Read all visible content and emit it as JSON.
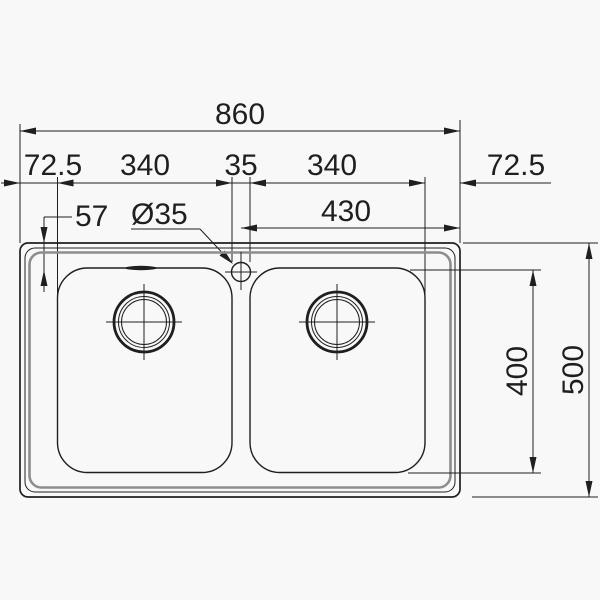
{
  "drawing": {
    "title": "double-bowl-sink-dimension-drawing",
    "dims": {
      "overall_width": "860",
      "margin_left": "72.5",
      "bowl_width_left": "340",
      "tap_gap": "35",
      "bowl_width_right": "340",
      "margin_right": "72.5",
      "ledge_depth": "57",
      "tap_hole_diameter": "Ø35",
      "half_width": "430",
      "bowl_depth": "400",
      "overall_depth": "500"
    },
    "colors": {
      "line": "#1f1f1f",
      "rim": "#8d8d8d",
      "background": "#f8f8f8"
    }
  }
}
